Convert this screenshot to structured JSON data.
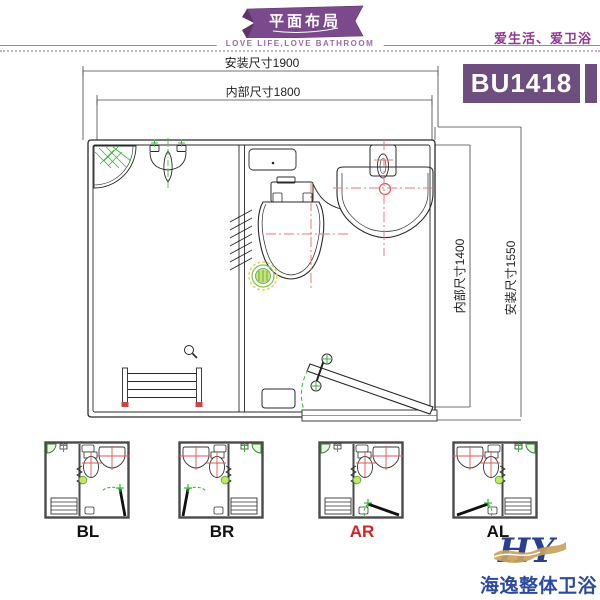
{
  "header": {
    "ribbon_title": "平面布局",
    "ribbon_subtitle": "LOVE LIFE,LOVE BATHROOM",
    "slogan": "爱生活、爱卫浴",
    "model_code": "BU1418"
  },
  "plan": {
    "dimensions": {
      "top_outer": "安装尺寸1900",
      "top_inner": "内部尺寸1800",
      "right_inner": "内部尺寸1400",
      "right_outer": "安装尺寸1550"
    },
    "fixtures": [
      "corner-shelf",
      "urinal",
      "towel-rack",
      "spring-symbol",
      "hook",
      "toilet",
      "floor-drain",
      "washbasin",
      "faucet",
      "door",
      "threshold",
      "storage-box",
      "cistern-shelf"
    ]
  },
  "variants": [
    {
      "label": "BL",
      "selected": false
    },
    {
      "label": "BR",
      "selected": false
    },
    {
      "label": "AR",
      "selected": true
    },
    {
      "label": "AL",
      "selected": false
    }
  ],
  "selected_variant": "AR",
  "footer": {
    "logo_text": "HY",
    "brand_name": "海逸整体卫浴"
  },
  "colors": {
    "brand_purple": "#7b4a8c",
    "badge_purple": "#6d4e7e",
    "accent_magenta": "#8e3a8e",
    "cad_line": "#2a2a2a",
    "cad_red": "#e87878",
    "cad_green": "#2db82d",
    "drain_yellow": "#e6d44c",
    "selected_red": "#d42222",
    "logo_blue": "#2a3f8f",
    "logo_gold": "#c9a35f",
    "brand_blue": "#2b4aa0"
  }
}
